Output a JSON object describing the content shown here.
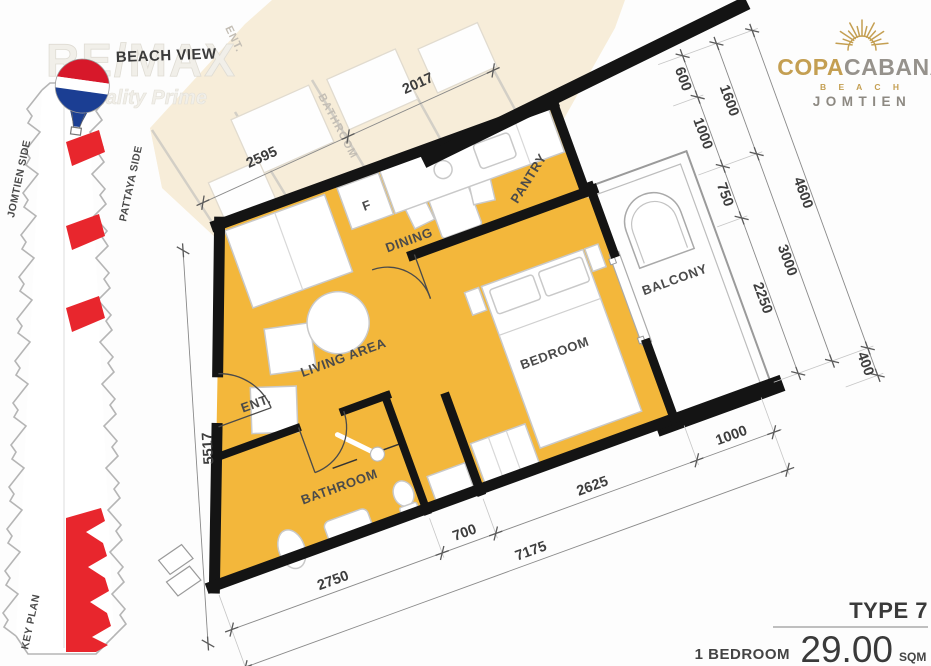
{
  "header": {
    "beach_view": "BEACH VIEW",
    "watermark": "RE/MAX",
    "watermark_tagline": "Quality Prime"
  },
  "logo": {
    "copa": "COPA",
    "cabana": "CABANA",
    "beach": "B E A C H",
    "jomtien": "JOMTIEN"
  },
  "keyplan": {
    "left_label": "JOMTIEN SIDE",
    "right_label": "PATTAYA SIDE",
    "bottom_label": "KEY PLAN"
  },
  "plan": {
    "rooms": {
      "living": "LIVING AREA",
      "dining": "DINING",
      "pantry": "PANTRY",
      "fridge": "F",
      "bedroom": "BEDROOM",
      "bathroom": "BATHROOM",
      "balcony": "BALCONY",
      "entrance": "ENT."
    },
    "neighbor": {
      "entrance": "ENT.",
      "bathroom": "BATHROOM"
    },
    "dims": {
      "top": [
        "2595",
        "2017"
      ],
      "left": "5517",
      "right_inner": [
        "600",
        "1000",
        "750",
        "2250"
      ],
      "right_mid": [
        "1600",
        "3000"
      ],
      "right_outer": [
        "4600",
        "400"
      ],
      "bottom_inner": [
        "2750",
        "700",
        "2625",
        "1000"
      ],
      "bottom_outer": "7175"
    }
  },
  "footer": {
    "type": "TYPE 7",
    "bedroom": "1 BEDROOM",
    "area": "29.00",
    "unit": "SQM"
  },
  "colors": {
    "floor": "#F3B73B",
    "wall": "#141414",
    "keyplan_highlight": "#E8262D",
    "neighbor_fill": "#F6EBD3",
    "logo_gold": "#C49F52",
    "logo_gray": "#96928C",
    "balloon_red": "#D7182A",
    "balloon_blue": "#1B3E93"
  }
}
